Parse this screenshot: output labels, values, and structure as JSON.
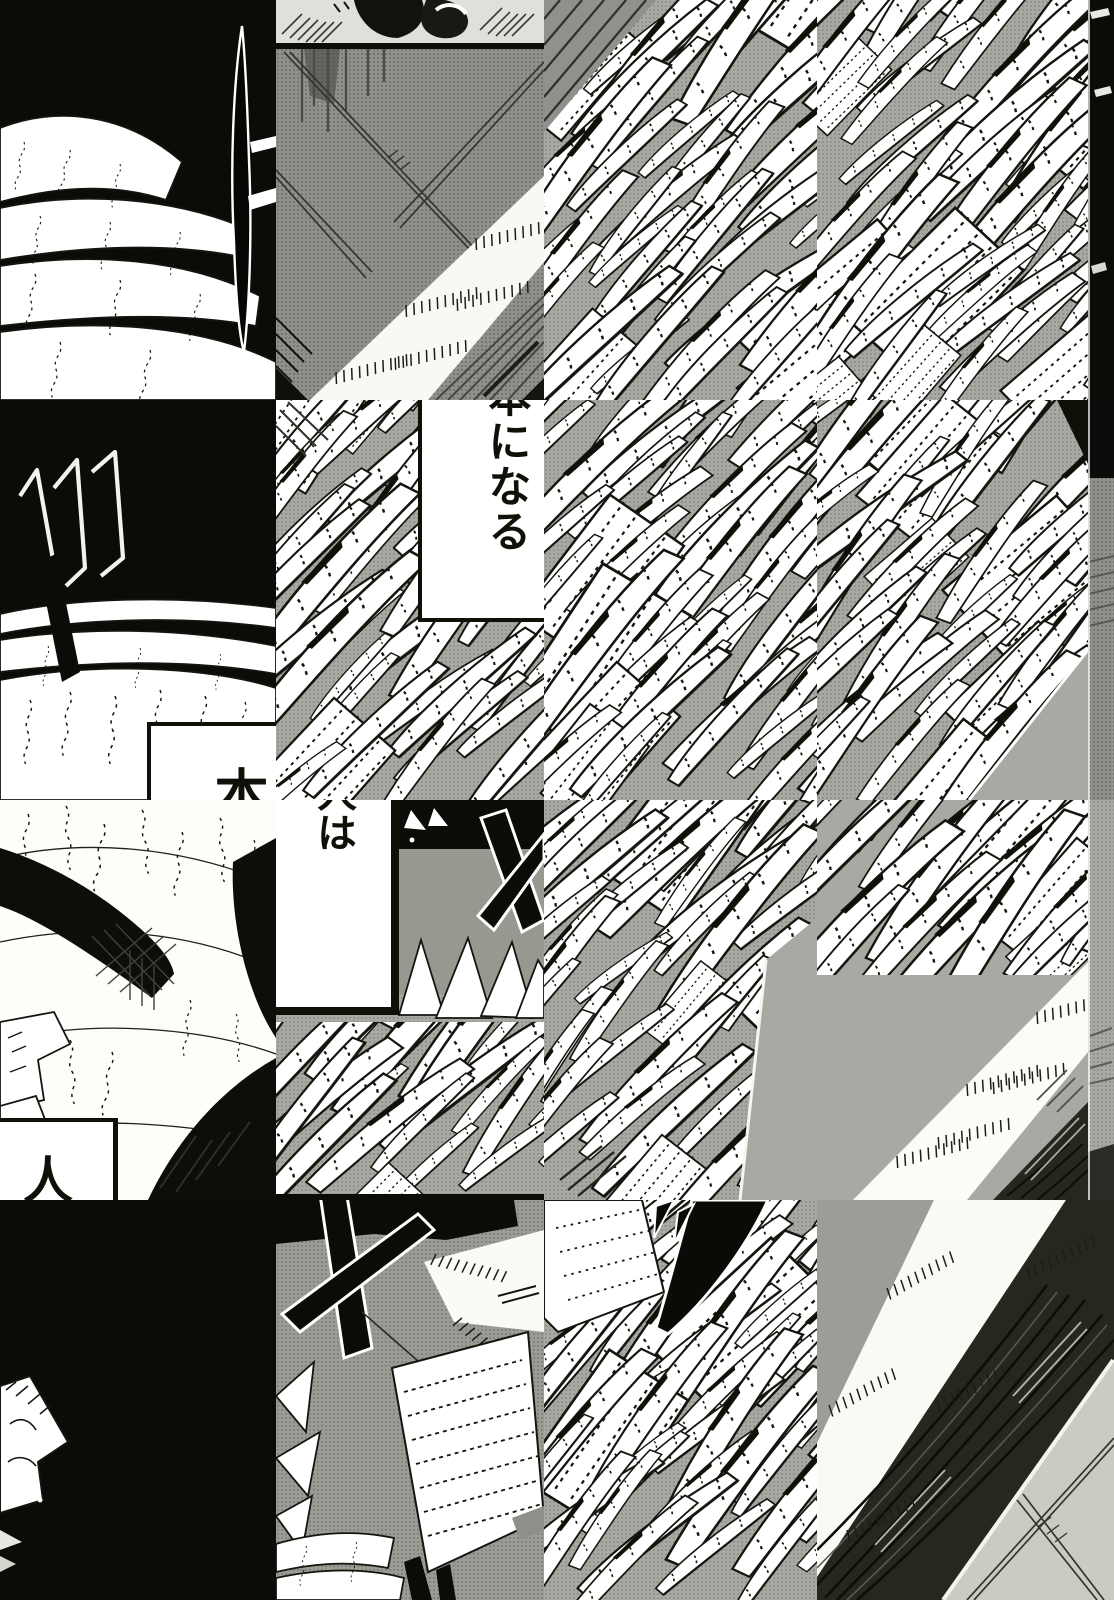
{
  "page": {
    "kind": "monochrome manga page collage of scattered paper panels"
  },
  "colors": {
    "ink": "#101009",
    "paper": "#ffffff",
    "halftone_gray": "#a7aaa2",
    "halftone_dark": "#8f928c",
    "floor_light": "#caccc4",
    "scribble_band": "#26281f"
  },
  "bubbles": {
    "become_book": {
      "text": "本になる"
    },
    "book": {
      "text": "本"
    },
    "person_wa": {
      "text": "人は"
    },
    "person": {
      "text": "人"
    }
  }
}
